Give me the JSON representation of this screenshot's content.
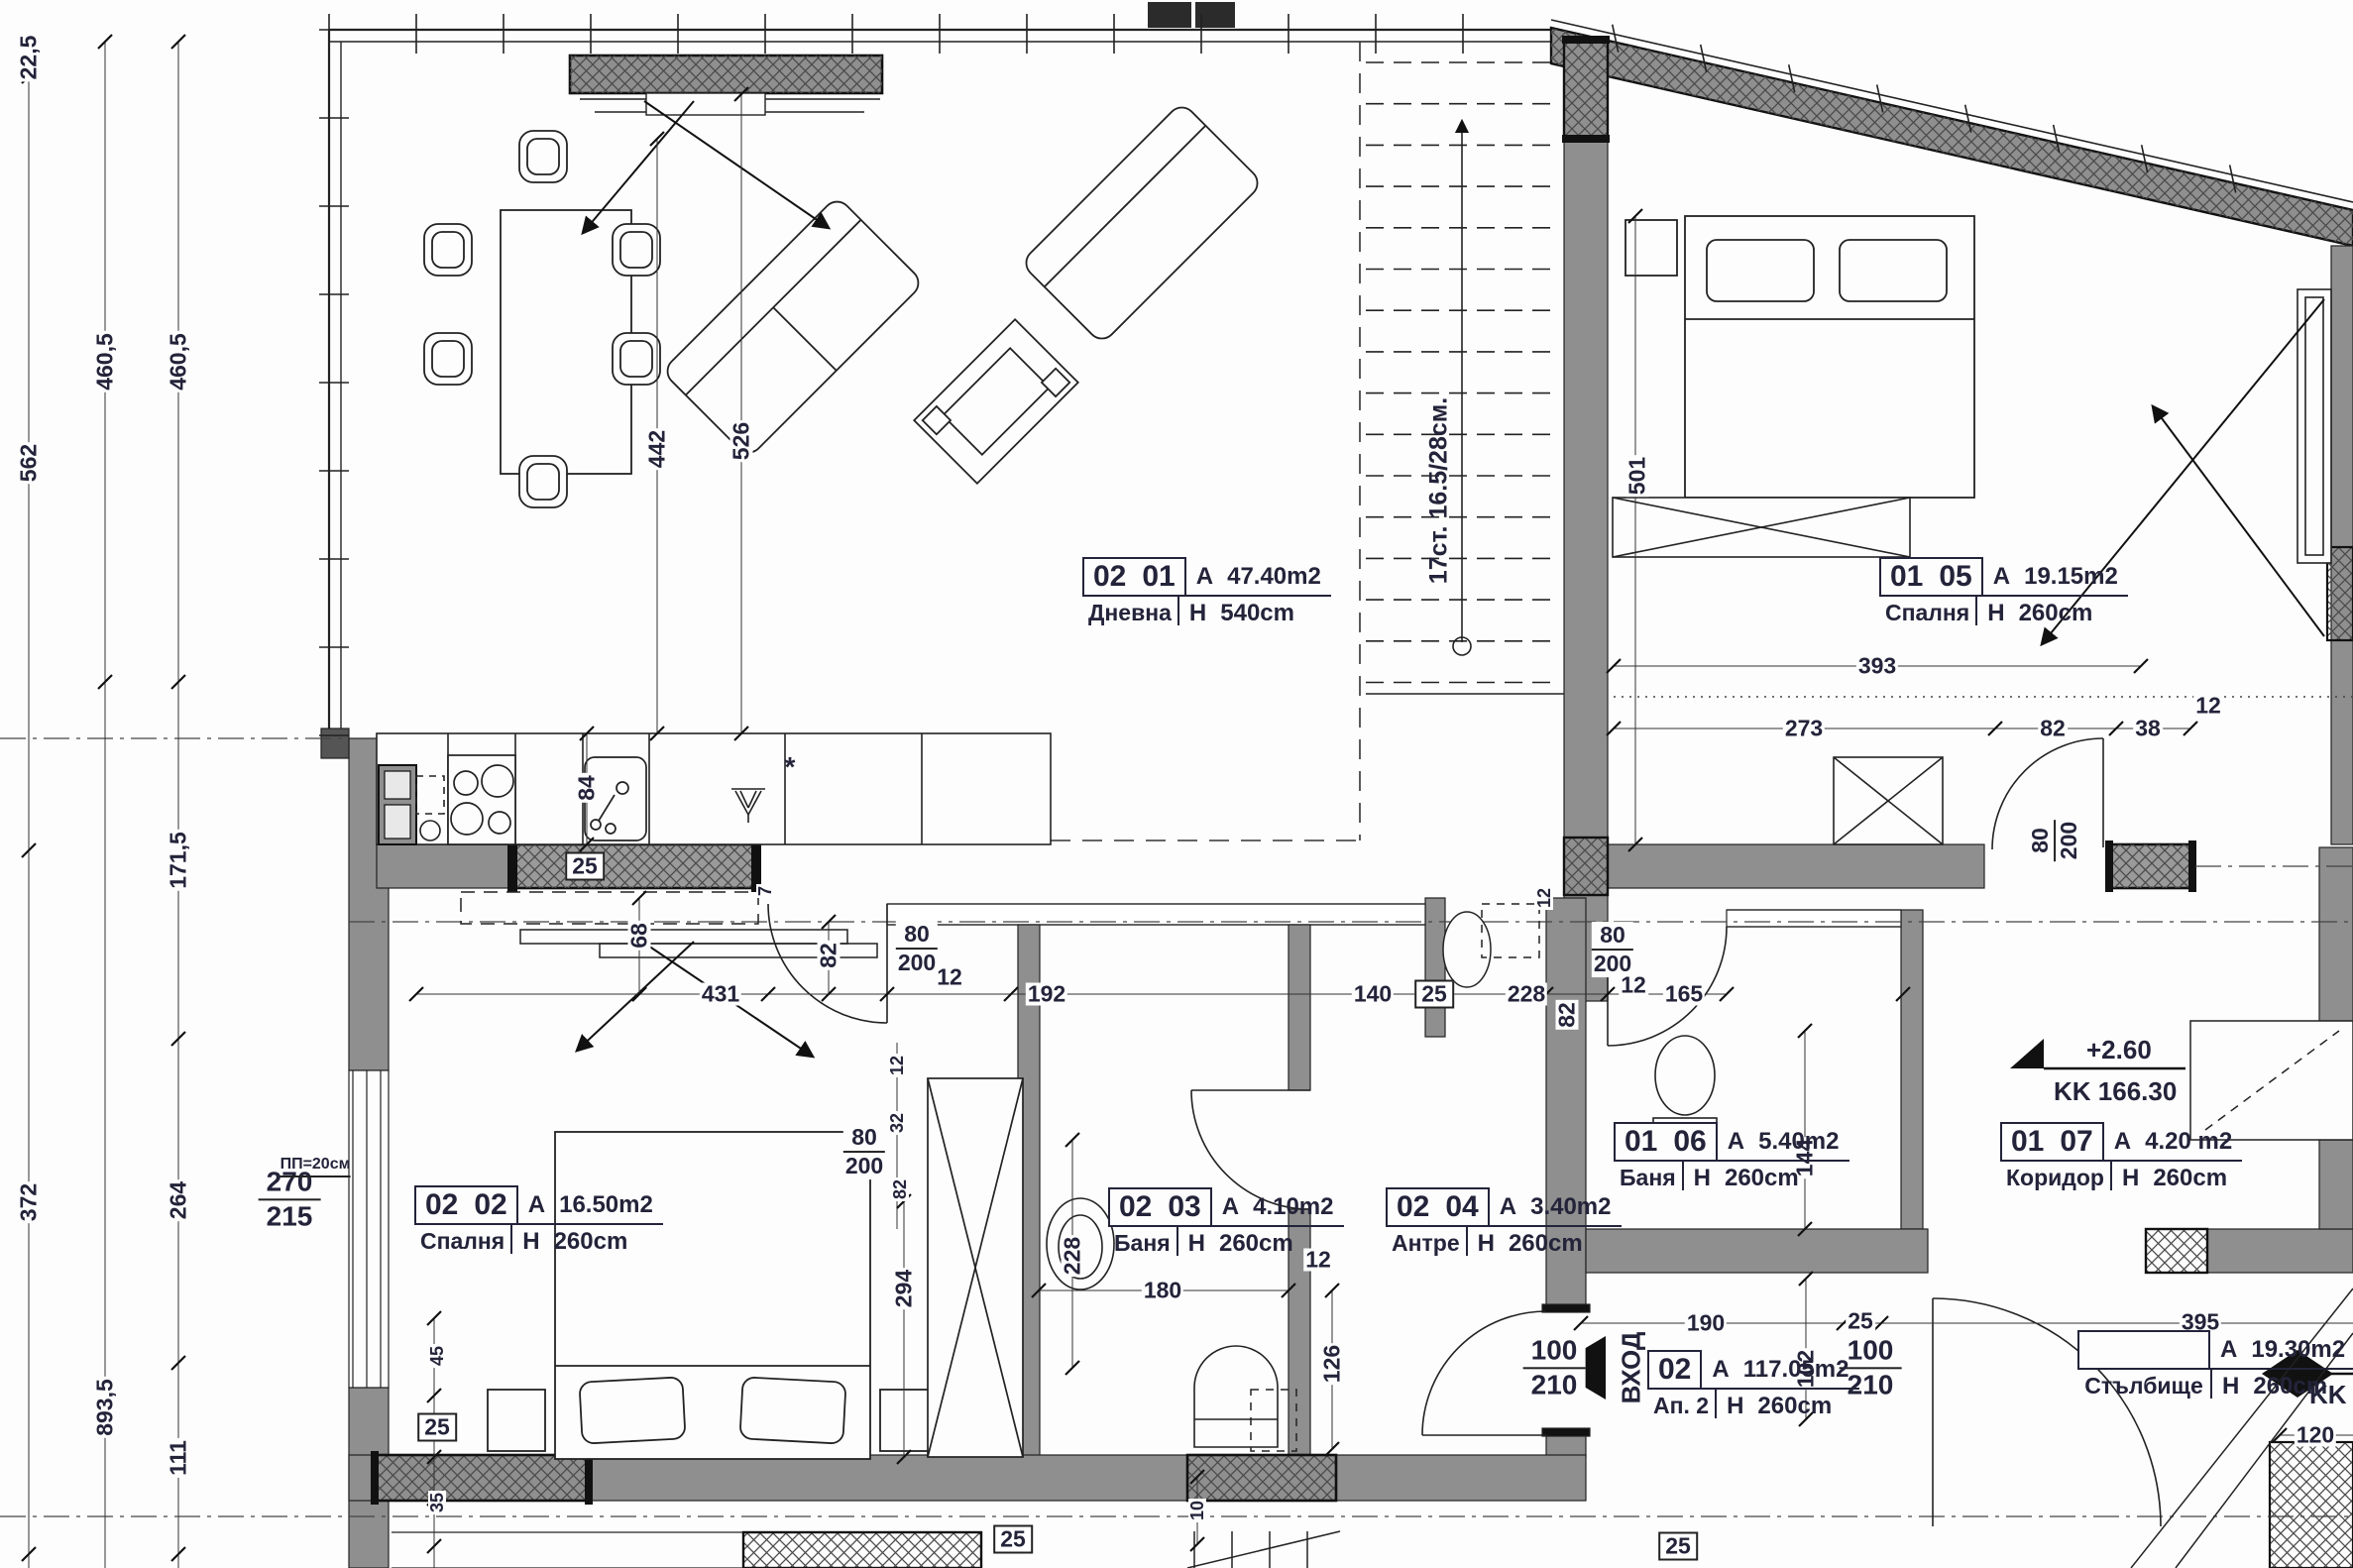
{
  "rooms": [
    {
      "n1": "02",
      "n2": "01",
      "area": "47.40m2",
      "name": "Дневна",
      "height": "540cm"
    },
    {
      "n1": "01",
      "n2": "05",
      "area": "19.15m2",
      "name": "Спалня",
      "height": "260cm"
    },
    {
      "n1": "02",
      "n2": "02",
      "area": "16.50m2",
      "name": "Спалня",
      "height": "260cm"
    },
    {
      "n1": "02",
      "n2": "03",
      "area": "4.10m2",
      "name": "Баня",
      "height": "260cm"
    },
    {
      "n1": "02",
      "n2": "04",
      "area": "3.40m2",
      "name": "Антре",
      "height": "260cm"
    },
    {
      "n1": "01",
      "n2": "06",
      "area": "5.40m2",
      "name": "Баня",
      "height": "260cm"
    },
    {
      "n1": "01",
      "n2": "07",
      "area": "4.20 m2",
      "name": "Коридор",
      "height": "260cm"
    },
    {
      "n1": "",
      "n2": "",
      "area": "19.30m2",
      "name": "Стълбище",
      "height": "260cm"
    },
    {
      "n1": "02",
      "n2": "",
      "area": "117.05m2",
      "name": "Ап. 2",
      "height": "260cm"
    }
  ],
  "prefix": {
    "area": "A",
    "height": "H"
  },
  "dims": [
    {
      "id": "d_22_5",
      "text": "22,5"
    },
    {
      "id": "d_562",
      "text": "562"
    },
    {
      "id": "d_460a",
      "text": "460,5"
    },
    {
      "id": "d_460b",
      "text": "460,5"
    },
    {
      "id": "d_171",
      "text": "171,5"
    },
    {
      "id": "d_372",
      "text": "372"
    },
    {
      "id": "d_264",
      "text": "264"
    },
    {
      "id": "d_893",
      "text": "893,5"
    },
    {
      "id": "d_111",
      "text": "111"
    },
    {
      "id": "d_442",
      "text": "442"
    },
    {
      "id": "d_526",
      "text": "526"
    },
    {
      "id": "d_84",
      "text": "84"
    },
    {
      "id": "d_25k",
      "text": "25"
    },
    {
      "id": "d_7",
      "text": "7"
    },
    {
      "id": "d_68",
      "text": "68"
    },
    {
      "id": "d_431",
      "text": "431"
    },
    {
      "id": "d_82a",
      "text": "82"
    },
    {
      "id": "d_80a",
      "text": "80/200"
    },
    {
      "id": "d_12a",
      "text": "12"
    },
    {
      "id": "d_192",
      "text": "192"
    },
    {
      "id": "d_140",
      "text": "140"
    },
    {
      "id": "d_25w",
      "text": "25"
    },
    {
      "id": "d_228a",
      "text": "228"
    },
    {
      "id": "d_82b",
      "text": "82"
    },
    {
      "id": "d_80b",
      "text": "80/200"
    },
    {
      "id": "d_12b",
      "text": "12"
    },
    {
      "id": "d_165",
      "text": "165"
    },
    {
      "id": "d_393",
      "text": "393"
    },
    {
      "id": "d_273",
      "text": "273"
    },
    {
      "id": "d_82c",
      "text": "82"
    },
    {
      "id": "d_38",
      "text": "38"
    },
    {
      "id": "d_12c",
      "text": "12"
    },
    {
      "id": "d_80c",
      "text": "80/200"
    },
    {
      "id": "d_501",
      "text": "501"
    },
    {
      "id": "d_12d",
      "text": "12"
    },
    {
      "id": "d_12e",
      "text": "12"
    },
    {
      "id": "d_32",
      "text": "32"
    },
    {
      "id": "d_80d",
      "text": "80/200"
    },
    {
      "id": "d_82d",
      "text": "82"
    },
    {
      "id": "d_294",
      "text": "294"
    },
    {
      "id": "d_228b",
      "text": "228"
    },
    {
      "id": "d_180",
      "text": "180"
    },
    {
      "id": "d_12f",
      "text": "12"
    },
    {
      "id": "d_126",
      "text": "126"
    },
    {
      "id": "d_190",
      "text": "190"
    },
    {
      "id": "d_25a",
      "text": "25"
    },
    {
      "id": "d_102",
      "text": "102"
    },
    {
      "id": "d_100a",
      "text": "100/210"
    },
    {
      "id": "d_100b",
      "text": "100/210"
    },
    {
      "id": "d_395",
      "text": "395"
    },
    {
      "id": "d_120",
      "text": "120"
    },
    {
      "id": "d_45",
      "text": "45"
    },
    {
      "id": "d_25b",
      "text": "25"
    },
    {
      "id": "d_35",
      "text": "35"
    },
    {
      "id": "d_10",
      "text": "10"
    },
    {
      "id": "d_25c",
      "text": "25"
    },
    {
      "id": "d_25d",
      "text": "25"
    },
    {
      "id": "d_270",
      "text": "270/215"
    },
    {
      "id": "d_144",
      "text": "144"
    }
  ],
  "notes": {
    "stairs": "17ст. 16.5/28см.",
    "entrance": "ВХОД",
    "pp": "ПП=20см",
    "star": "*"
  },
  "levels": {
    "l1_top": "+2.60",
    "l1_bot": "KK  166.30",
    "l2": "KK  1"
  }
}
